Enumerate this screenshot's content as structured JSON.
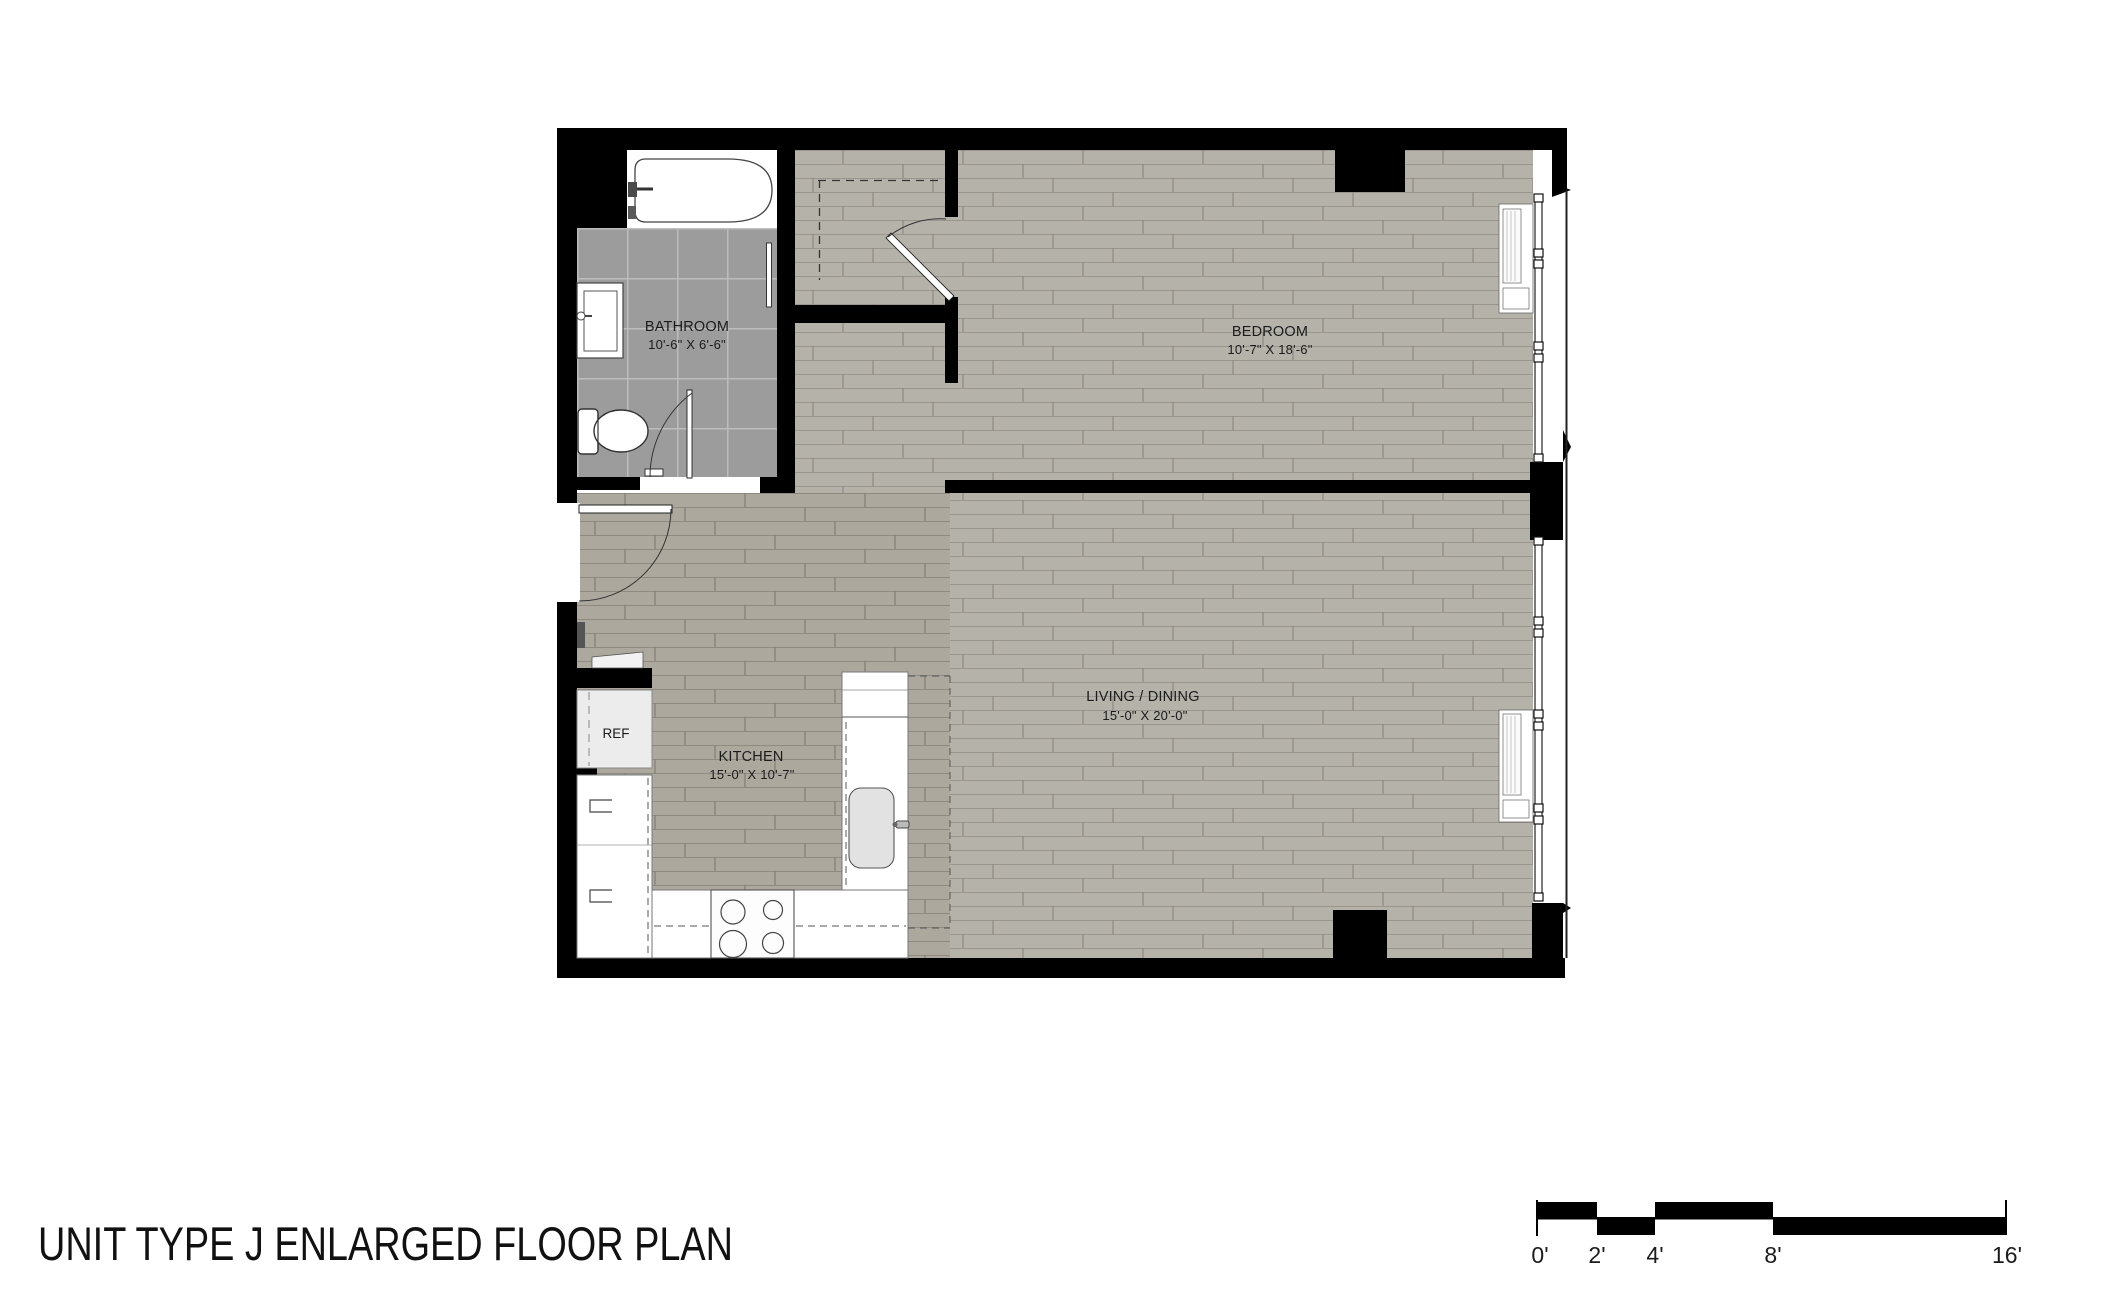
{
  "title": "UNIT TYPE J ENLARGED FLOOR PLAN",
  "rooms": {
    "bathroom": {
      "name": "BATHROOM",
      "dims": "10'-6\" X 6'-6\""
    },
    "bedroom": {
      "name": "BEDROOM",
      "dims": "10'-7\" X 18'-6\""
    },
    "living_dining": {
      "name": "LIVING / DINING",
      "dims": "15'-0\" X 20'-0\""
    },
    "kitchen": {
      "name": "KITCHEN",
      "dims": "15'-0\" X 10'-7\""
    }
  },
  "labels": {
    "refrigerator": "REF"
  },
  "scale_bar": {
    "ticks": [
      "0'",
      "2'",
      "4'",
      "8'",
      "16'"
    ]
  },
  "colors": {
    "wall": "#000000",
    "plank_floor_light": "#b5b2aa",
    "plank_floor_dark": "#aca89e",
    "bathroom_tile": "#9c9c9c",
    "fixture_fill": "#ffffff"
  }
}
